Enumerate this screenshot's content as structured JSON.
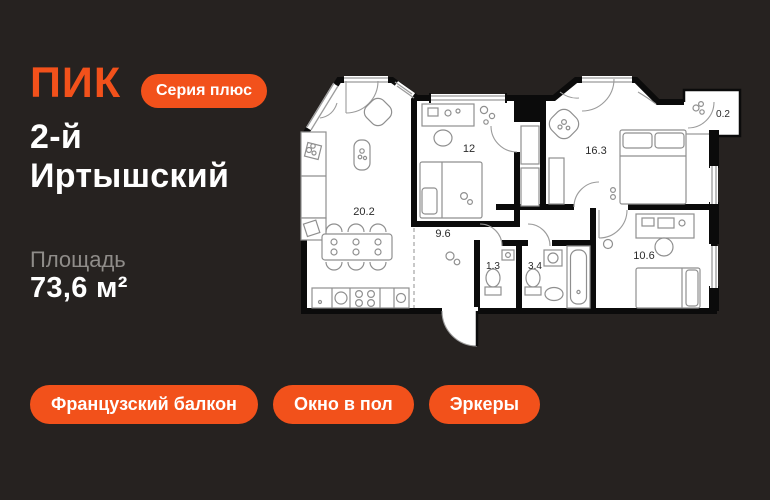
{
  "colors": {
    "background": "#262220",
    "accent": "#F2511B",
    "text_primary": "#FFFFFF",
    "text_muted": "#8F8C89",
    "plan_floor": "#FFFFFF",
    "plan_wall": "#0B0B0B"
  },
  "brand": {
    "logo": "ПИК",
    "series_badge": "Серия плюс"
  },
  "project": {
    "title_line1": "2-й",
    "title_line2": "Иртышский"
  },
  "area": {
    "label": "Площадь",
    "value": "73,6 м²"
  },
  "features": [
    {
      "label": "Французский балкон"
    },
    {
      "label": "Окно в пол"
    },
    {
      "label": "Эркеры"
    }
  ],
  "floor_plan": {
    "rooms": [
      {
        "name": "kitchen-living",
        "area": "20.2"
      },
      {
        "name": "bedroom-1",
        "area": "12"
      },
      {
        "name": "hallway",
        "area": "9.6"
      },
      {
        "name": "wc",
        "area": "1.3"
      },
      {
        "name": "bathroom",
        "area": "3.4"
      },
      {
        "name": "bedroom-master",
        "area": "16.3"
      },
      {
        "name": "bedroom-2",
        "area": "10.6"
      },
      {
        "name": "balcony",
        "area": "0.2"
      }
    ]
  }
}
